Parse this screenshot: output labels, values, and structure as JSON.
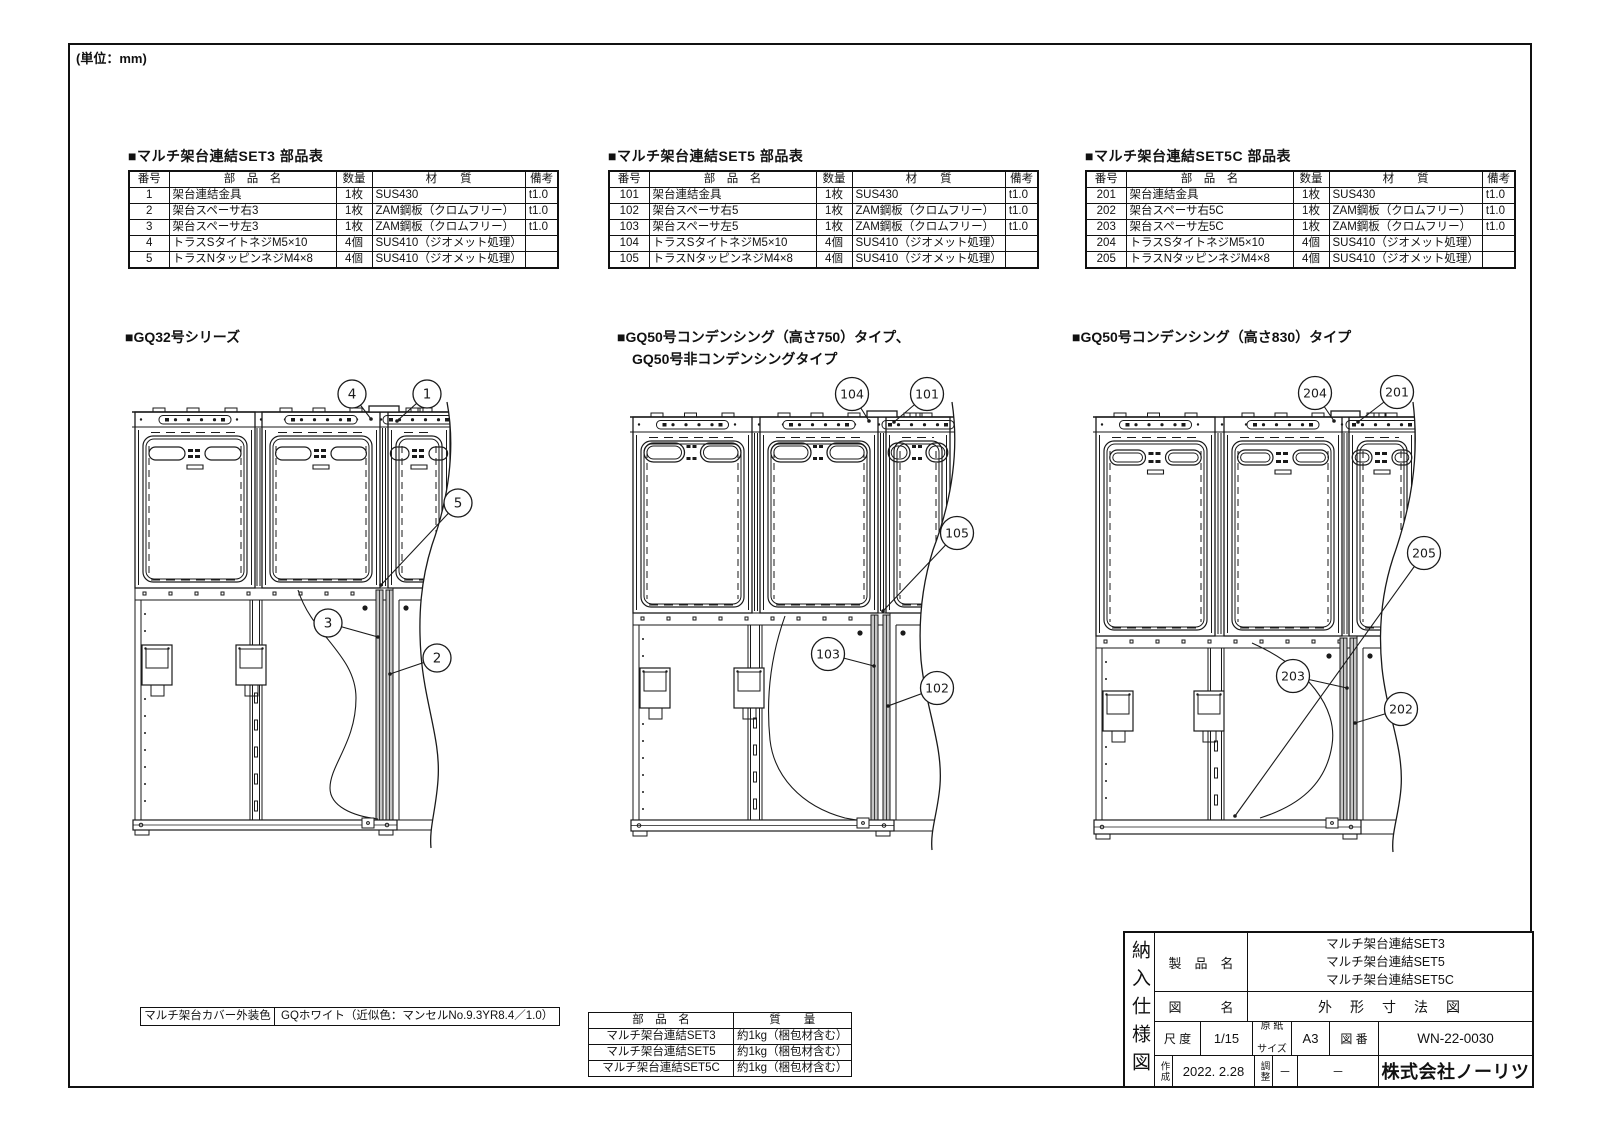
{
  "page": {
    "units_note": "(単位：mm)"
  },
  "parts_tables": [
    {
      "title": "■マルチ架台連結SET3 部品表",
      "headers": [
        "番号",
        "部　品　名",
        "数量",
        "材　　質",
        "備考"
      ],
      "rows": [
        [
          "1",
          "架台連結金具",
          "1枚",
          "SUS430",
          "t1.0"
        ],
        [
          "2",
          "架台スペーサ右3",
          "1枚",
          "ZAM鋼板（クロムフリー）",
          "t1.0"
        ],
        [
          "3",
          "架台スペーサ左3",
          "1枚",
          "ZAM鋼板（クロムフリー）",
          "t1.0"
        ],
        [
          "4",
          "トラスSタイトネジM5×10",
          "4個",
          "SUS410（ジオメット処理）",
          ""
        ],
        [
          "5",
          "トラスNタッピンネジM4×8",
          "4個",
          "SUS410（ジオメット処理）",
          ""
        ]
      ]
    },
    {
      "title": "■マルチ架台連結SET5 部品表",
      "headers": [
        "番号",
        "部　品　名",
        "数量",
        "材　　質",
        "備考"
      ],
      "rows": [
        [
          "101",
          "架台連結金具",
          "1枚",
          "SUS430",
          "t1.0"
        ],
        [
          "102",
          "架台スペーサ右5",
          "1枚",
          "ZAM鋼板（クロムフリー）",
          "t1.0"
        ],
        [
          "103",
          "架台スペーサ左5",
          "1枚",
          "ZAM鋼板（クロムフリー）",
          "t1.0"
        ],
        [
          "104",
          "トラスSタイトネジM5×10",
          "4個",
          "SUS410（ジオメット処理）",
          ""
        ],
        [
          "105",
          "トラスNタッピンネジM4×8",
          "4個",
          "SUS410（ジオメット処理）",
          ""
        ]
      ]
    },
    {
      "title": "■マルチ架台連結SET5C 部品表",
      "headers": [
        "番号",
        "部　品　名",
        "数量",
        "材　　質",
        "備考"
      ],
      "rows": [
        [
          "201",
          "架台連結金具",
          "1枚",
          "SUS430",
          "t1.0"
        ],
        [
          "202",
          "架台スペーサ右5C",
          "1枚",
          "ZAM鋼板（クロムフリー）",
          "t1.0"
        ],
        [
          "203",
          "架台スペーサ左5C",
          "1枚",
          "ZAM鋼板（クロムフリー）",
          "t1.0"
        ],
        [
          "204",
          "トラスSタイトネジM5×10",
          "4個",
          "SUS410（ジオメット処理）",
          ""
        ],
        [
          "205",
          "トラスNタッピンネジM4×8",
          "4個",
          "SUS410（ジオメット処理）",
          ""
        ]
      ]
    }
  ],
  "sections": [
    {
      "title": "■GQ32号シリーズ",
      "title2": "",
      "balloons": [
        "4",
        "1",
        "5",
        "3",
        "2"
      ]
    },
    {
      "title": "■GQ50号コンデンシング（高さ750）タイプ、",
      "title2": "GQ50号非コンデンシングタイプ",
      "balloons": [
        "104",
        "101",
        "105",
        "103",
        "102"
      ]
    },
    {
      "title": "■GQ50号コンデンシング（高さ830）タイプ",
      "title2": "",
      "balloons": [
        "204",
        "201",
        "205",
        "203",
        "202"
      ]
    }
  ],
  "color_note": {
    "label": "マルチ架台カバー外装色",
    "value": "GQホワイト（近似色：マンセルNo.9.3YR8.4／1.0）"
  },
  "mass_table": {
    "headers": [
      "部　品　名",
      "質　　量"
    ],
    "rows": [
      [
        "マルチ架台連結SET3",
        "約1kg（梱包材含む）"
      ],
      [
        "マルチ架台連結SET5",
        "約1kg（梱包材含む）"
      ],
      [
        "マルチ架台連結SET5C",
        "約1kg（梱包材含む）"
      ]
    ]
  },
  "title_block": {
    "doc_type": "納入仕様図",
    "product_label": "製　品　名",
    "products": [
      "マルチ架台連結SET3",
      "マルチ架台連結SET5",
      "マルチ架台連結SET5C"
    ],
    "drawing_label": "図　　　名",
    "drawing_name": "外　形　寸　法　図",
    "scale_label": "尺 度",
    "scale": "1/15",
    "paper_label_1": "原 紙",
    "paper_label_2": "サイズ",
    "paper": "A3",
    "number_label": "図 番",
    "number": "WN-22-0030",
    "created_label": "作成",
    "created": "2022. 2.28",
    "adjust_label": "調整",
    "adjust": "－",
    "dash": "－",
    "company": "株式会社ノーリツ"
  }
}
